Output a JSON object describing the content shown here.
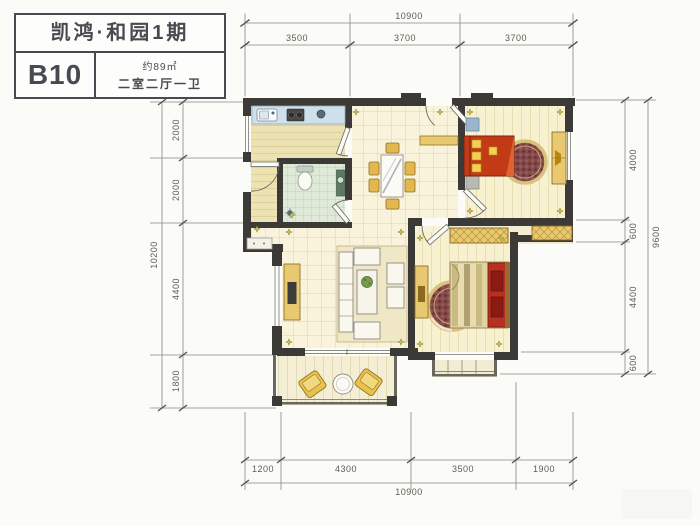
{
  "title_block": {
    "project": "凯鸿·和园1期",
    "unit": "B10",
    "area": "约89㎡",
    "rooms": "二室二厅一卫"
  },
  "dimensions": {
    "top": {
      "total": "10900",
      "segments": [
        "3500",
        "3700",
        "3700"
      ]
    },
    "bottom": {
      "total": "10900",
      "segments": [
        "1200",
        "4300",
        "3500",
        "1900"
      ]
    },
    "left": {
      "total": "10200",
      "segments": [
        "2000",
        "2000",
        "4400",
        "1800"
      ]
    },
    "right": {
      "total": "9600",
      "segments": [
        "4000",
        "600",
        "4400",
        "600"
      ]
    }
  },
  "colors": {
    "wall": "#3b3a36",
    "floor_tile": "#f8f3da",
    "kitchen_floor": "#ece2b2",
    "bath_floor": "#dfe9d7",
    "counter_blue": "#cfe0ec",
    "furniture_yellow": "#e9c96f",
    "bed_red": "#c23b16",
    "rug_maroon": "#854a4c",
    "dim_text": "#5f5c55",
    "title_text": "#474b51"
  }
}
